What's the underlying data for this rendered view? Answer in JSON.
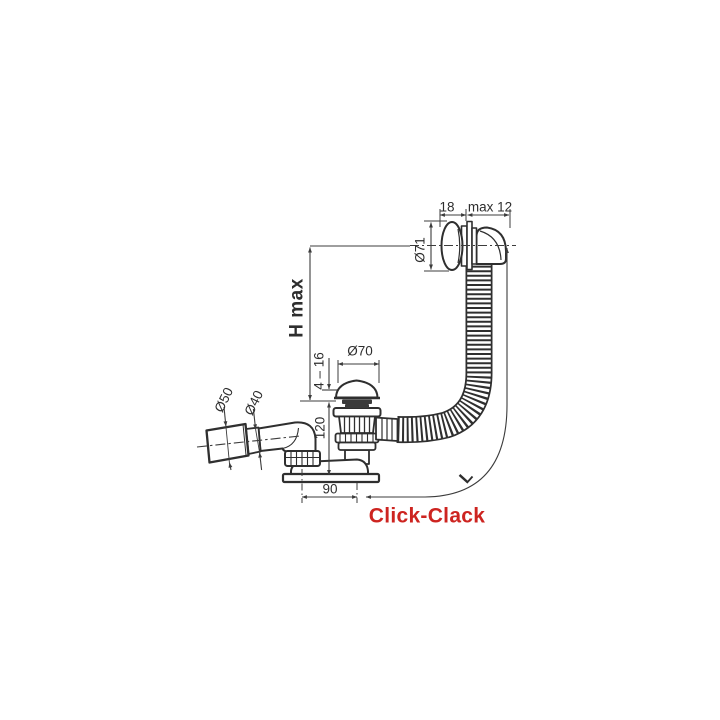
{
  "drawing": {
    "type": "technical-drawing",
    "product_label": {
      "text": "Click-Clack",
      "color": "#cd2420"
    },
    "line_color": "#2f2f2f",
    "dimension_color": "#3c3c3c",
    "dimensions": {
      "cap_width": "18",
      "wall_max": "max 12",
      "cap_diameter": "Ø71",
      "height_max": "H max",
      "plug_diameter": "Ø70",
      "plug_travel": "4 – 16",
      "outlet_outer": "Ø50",
      "outlet_inner": "Ø40",
      "body_height": "120",
      "offset": "90",
      "hose_length": "L"
    }
  }
}
